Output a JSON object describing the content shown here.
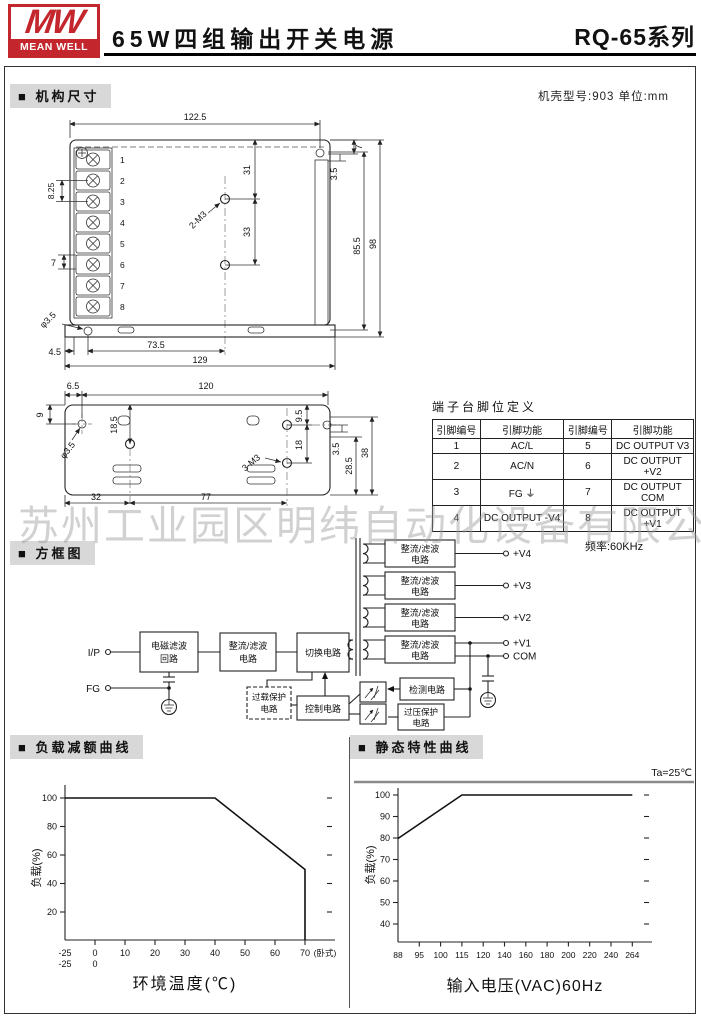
{
  "header": {
    "logo_mw": "MW",
    "logo_brand": "MEAN WELL",
    "title": "65W四组输出开关电源",
    "series": "RQ-65系列"
  },
  "mech": {
    "section_label": "■ 机构尺寸",
    "case_note": "机壳型号:903 单位:mm"
  },
  "drawing1": {
    "w": "122.5",
    "v1": "31",
    "v2": "33",
    "screw": "2-M3",
    "t7": "7",
    "t35": "3.5",
    "h855": "85.5",
    "h98": "98",
    "p825": "8.25",
    "p7": "7",
    "hole": "φ3.5",
    "b45": "4.5",
    "b735": "73.5",
    "b129": "129",
    "terminals": [
      "1",
      "2",
      "3",
      "4",
      "5",
      "6",
      "7",
      "8"
    ]
  },
  "drawing2": {
    "t65": "6.5",
    "t120": "120",
    "l9": "9",
    "v185": "18.5",
    "hole": "φ3.5",
    "r95": "9.5",
    "r18": "18",
    "screw": "3-M3",
    "r35": "3.5",
    "r285": "28.5",
    "r38": "38",
    "b32": "32",
    "b77": "77"
  },
  "pin_table": {
    "title": "端子台脚位定义",
    "headers": [
      "引脚编号",
      "引脚功能",
      "引脚编号",
      "引脚功能"
    ],
    "rows": [
      [
        "1",
        "AC/L",
        "5",
        "DC OUTPUT V3"
      ],
      [
        "2",
        "AC/N",
        "6",
        "DC OUTPUT +V2"
      ],
      [
        "3",
        "FG ⏚",
        "7",
        "DC OUTPUT COM"
      ],
      [
        "4",
        "DC OUTPUT -V4",
        "8",
        "DC OUTPUT +V1"
      ]
    ]
  },
  "watermark": "苏州工业园区明纬自动化设备有限公司",
  "block": {
    "section_label": "■ 方框图",
    "freq": "频率:60KHz",
    "ip": "I/P",
    "fg": "FG",
    "emi1": "电磁滤波",
    "emi2": "回路",
    "rf1": "整流/滤波",
    "rf2": "电路",
    "sw": "切换电路",
    "ol1": "过载保护",
    "ol2": "电路",
    "ctrl": "控制电路",
    "det": "检测电路",
    "ovp1": "过压保护",
    "ovp2": "电路",
    "v4": "+V4",
    "v3": "+V3",
    "v2": "+V2",
    "v1": "+V1",
    "com": "COM"
  },
  "charts": {
    "derating_label": "■ 负载减额曲线",
    "static_label": "■ 静态特性曲线"
  },
  "chart_data": [
    {
      "type": "line",
      "title": "负载减额曲线",
      "xlabel": "环境温度(℃)",
      "ylabel": "负载(%)",
      "x_note": "(卧式)",
      "xticks": [
        "-25",
        "0",
        "10",
        "20",
        "30",
        "40",
        "50",
        "60",
        "70"
      ],
      "xticks_row2": [
        "-25",
        "0"
      ],
      "ytick_labels": [
        "100",
        "80",
        "60",
        "40",
        "20"
      ],
      "yticks": [
        20,
        40,
        60,
        80,
        100
      ],
      "xlim": [
        -25,
        75
      ],
      "ylim": [
        0,
        110
      ],
      "grid": false,
      "legend": false,
      "points": [
        [
          -25,
          100
        ],
        [
          40,
          100
        ],
        [
          70,
          50
        ],
        [
          70,
          0
        ]
      ]
    },
    {
      "type": "line",
      "title": "静态特性曲线",
      "annotation": "Ta=25℃",
      "xlabel": "输入电压(VAC)60Hz",
      "ylabel": "负载(%)",
      "xticks": [
        "88",
        "95",
        "100",
        "115",
        "120",
        "140",
        "160",
        "180",
        "200",
        "220",
        "240",
        "264"
      ],
      "ytick_labels": [
        "100",
        "90",
        "80",
        "70",
        "60",
        "50",
        "40"
      ],
      "yticks": [
        40,
        50,
        60,
        70,
        80,
        90,
        100
      ],
      "ylim": [
        30,
        105
      ],
      "grid": false,
      "legend": false,
      "x_scale": "uniform tick spacing (non-linear VAC scale)",
      "points": [
        [
          88,
          80
        ],
        [
          115,
          100
        ],
        [
          264,
          100
        ]
      ]
    }
  ]
}
